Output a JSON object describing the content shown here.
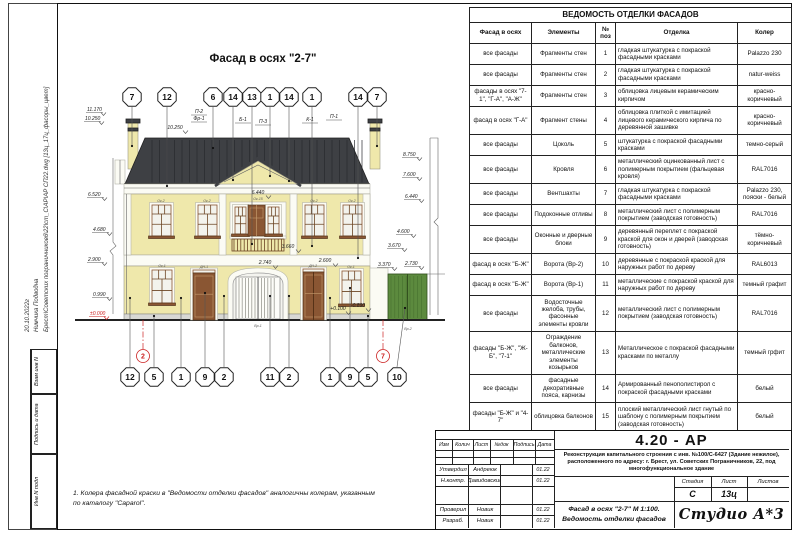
{
  "sidebar": {
    "date": "20.10.2022г",
    "author": "Нимчика Подводна",
    "file_path": "Брест\\Советских пограничников6\\22\\cm_C\\АР\\АР СП22.dwg [13ц_17ц_фасоры_цвет]",
    "boxes": [
      "Взам инв N",
      "Подпись и дата",
      "Инв N подл"
    ]
  },
  "drawing": {
    "title": "Фасад в осях \"2-7\"",
    "top_callouts": [
      "7",
      "12",
      "6",
      "14",
      "13",
      "1",
      "14",
      "1",
      "14",
      "7"
    ],
    "bottom_callouts": [
      "12",
      "5",
      "1",
      "9",
      "2",
      "11",
      "2",
      "1",
      "9",
      "5",
      "10"
    ],
    "axis_bubbles": [
      "2",
      "7"
    ],
    "leader_labels": [
      "П-2",
      "Фр-1",
      "Б-1",
      "П-3",
      "К-1",
      "П-1"
    ],
    "elevations_left": [
      "11.170",
      "10.250",
      "6.520",
      "4.680",
      "2.900",
      "0.990",
      "±0.000"
    ],
    "elevations_right": [
      "8.750",
      "7.600",
      "6.440",
      "4.600",
      "3.670",
      "3.370",
      "2.730"
    ],
    "inline_dims": [
      "10.250",
      "6.440",
      "3.660",
      "2.740",
      "2.600",
      "+0.100",
      "-0.890"
    ],
    "element_tags": [
      "Ок-2",
      "Ок-2",
      "Ок-15",
      "Ок-2",
      "Ок-2",
      "Ок-1",
      "ДН-1",
      "Ок-1",
      "ДН-2",
      "Вр-1",
      "Вр-2"
    ],
    "note": "1.   Колера фасадной краски в \"Ведомости отделки фасадов\" аналогичны колерам, указанным\nпо каталогу \"Caparol\"."
  },
  "finish_table": {
    "title": "ВЕДОМОСТЬ ОТДЕЛКИ ФАСАДОВ",
    "headers": [
      "Фасад в осях",
      "Элементы",
      "№ поз",
      "Отделка",
      "Колер"
    ],
    "rows": [
      [
        "все фасады",
        "Фрагменты стен",
        "1",
        "гладкая штукатурка с покраской фасадными красками",
        "Palazzo 230"
      ],
      [
        "все фасады",
        "Фрагменты стен",
        "2",
        "гладкая штукатурка с покраской фасадными красками",
        "natur-weiss"
      ],
      [
        "фасады в осях \"7-1\", \"Г-А\", \"А-Ж\"",
        "Фрагменты стен",
        "3",
        "облицовка лицевым керамическим кирпичом",
        "красно-коричневый"
      ],
      [
        "фасад в осях \"Г-А\"",
        "Фрагмент стены",
        "4",
        "облицовка плиткой с имитацией лицевого керамического кирпича по деревянной зашивке",
        "красно-коричневый"
      ],
      [
        "все фасады",
        "Цоколь",
        "5",
        "штукатурка с покраской фасадными красками",
        "темно-серый"
      ],
      [
        "все фасады",
        "Кровля",
        "6",
        "металлический оцинкованный лист с полимерным покрытием (фальцевая кровля)",
        "RAL7016"
      ],
      [
        "все фасады",
        "Вентшахты",
        "7",
        "гладкая штукатурка с покраской фасадными красками",
        "Palazzo 230, пояски - белый"
      ],
      [
        "все фасады",
        "Подоконные отливы",
        "8",
        "металлический лист с полимерным покрытием (заводская готовность)",
        "RAL7016"
      ],
      [
        "все фасады",
        "Оконные и дверные блоки",
        "9",
        "деревянный переплет с покраской краской для окон и дверей (заводская готовность)",
        "тёмно-коричневый"
      ],
      [
        "фасад в осях \"Б-Ж\"",
        "Ворота (Вр-2)",
        "10",
        "деревянные с покраской краской для наружных работ по дереву",
        "RAL6013"
      ],
      [
        "фасад в осях \"Б-Ж\"",
        "Ворота (Вр-1)",
        "11",
        "металлические с покраской краской для наружных работ по дереву",
        "темный графит"
      ],
      [
        "все фасады",
        "Водосточные желоба, трубы, фасонные элементы кровли",
        "12",
        "металлический лист с полимерным покрытием (заводская готовность)",
        "RAL7016"
      ],
      [
        "фасады \"Б-Ж\", \"Ж-Б\", \"7-1\"",
        "Ограждение балконов, металлические элементы козырьков",
        "13",
        "Металлическое с покраской фасадными красками по металлу",
        "темный грфит"
      ],
      [
        "все фасады",
        "фасадные декоративные пояса, карнизы",
        "14",
        "Армированный пенополистирол с покраской фасадными красками",
        "белый"
      ],
      [
        "фасады \"Б-Ж\" и \"4-7\"",
        "облицовка балконов",
        "15",
        "плоский металлический лист гнутый по шаблону с полимерным покрытием (заводская готовность)",
        "белый"
      ],
      [
        "все фасады",
        "площадки крылец",
        "16",
        "Пиленые гранитные плиты",
        "темно-серый"
      ],
      [
        "фасады \"1-7\", \"7-1\"",
        "двери в инженерные помещения",
        "17",
        "Деревянные с покраской в заводских условиях",
        "темно-коричневый"
      ],
      [
        "",
        "",
        "",
        "",
        ""
      ]
    ]
  },
  "title_block": {
    "doc_number": "4.20 - АР",
    "project": "Реконструкция капитального строения с инв. №100/С-6427 (Здание нежилое), расположенного по адресу: г. Брест, ул. Советских Пограничников, 22, под многофункциональное здание",
    "drawing_caption": "Фасад в осях \"2-7\" М 1:100. Ведомость отделки фасадов",
    "revision_headers": [
      "Изм",
      "Колич",
      "Лист",
      "№док",
      "Подпись",
      "Дата"
    ],
    "signature_rows": [
      {
        "role": "Утвердил",
        "name": "Андреюк",
        "date": "01.22"
      },
      {
        "role": "Н.контр.",
        "name": "Давидовский",
        "date": "01.22"
      },
      {
        "role": "Проверил",
        "name": "Новик",
        "date": "01.22"
      },
      {
        "role": "Разраб.",
        "name": "Новик",
        "date": "01.22"
      }
    ],
    "stage_label": "Стадия",
    "stage": "С",
    "sheet_label": "Лист",
    "sheet": "13ц",
    "sheets_label": "Листов",
    "sheets": "",
    "logo": "Студио А*3"
  },
  "colors": {
    "wall": "#efe8ab",
    "roof": "#3e4044",
    "trim": "#fbfbf4",
    "wood": "#8a5633",
    "green_gate": "#5c8a3e",
    "accent_red": "#cc2222",
    "line": "#1d1d1d"
  }
}
